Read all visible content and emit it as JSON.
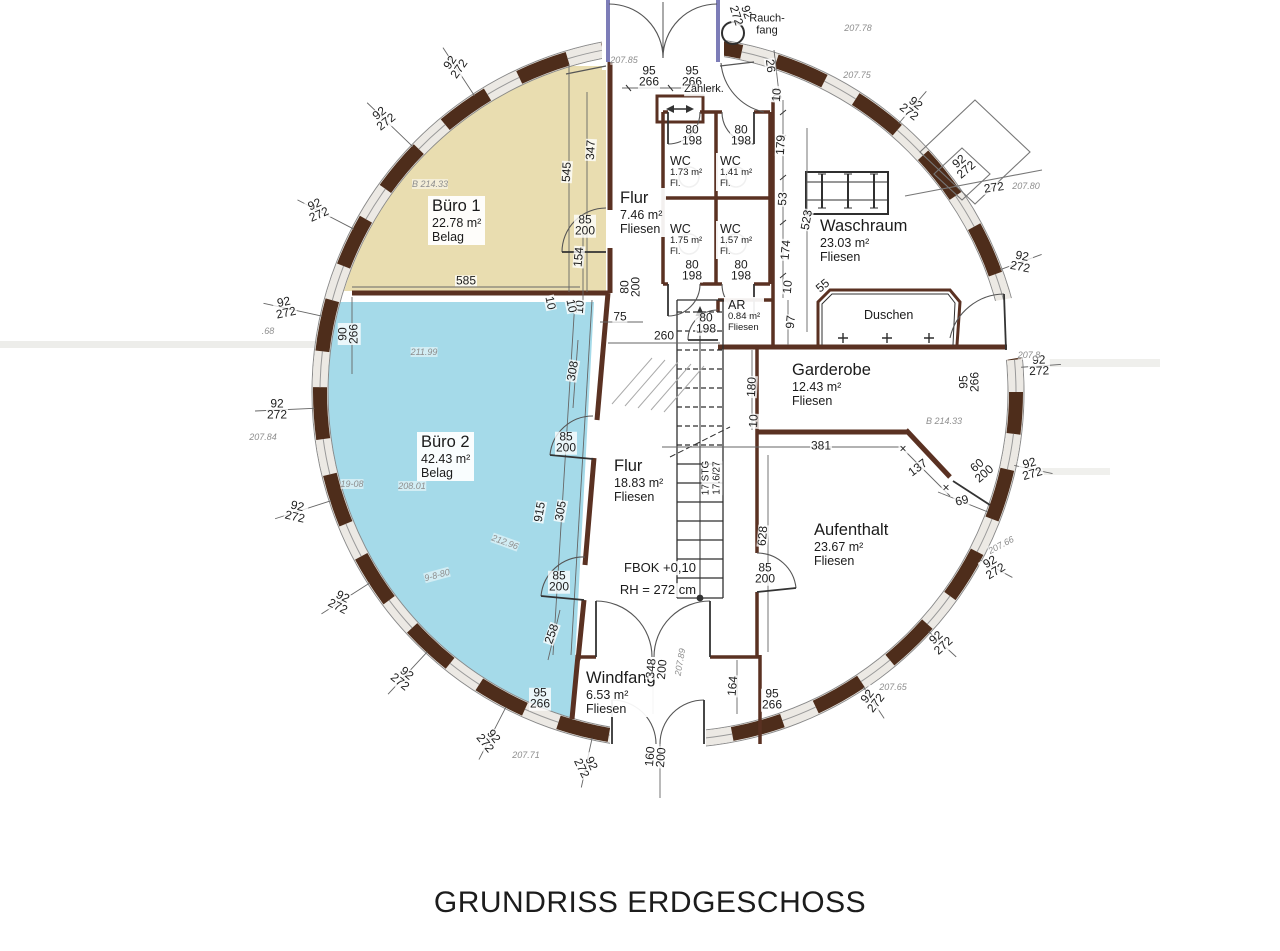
{
  "title": "GRUNDRISS ERDGESCHOSS",
  "colors": {
    "buero1_fill": "#e9ddb0",
    "buero2_fill": "#a5dae9",
    "wall": "#5a3122",
    "ring_dark": "#4e2d1b"
  },
  "rooms": [
    {
      "id": "buero1",
      "name": "Büro 1",
      "area": "22.78 m²",
      "floor": "Belag",
      "x": 428,
      "y": 196,
      "size": "l"
    },
    {
      "id": "buero2",
      "name": "Büro 2",
      "area": "42.43 m²",
      "floor": "Belag",
      "x": 417,
      "y": 432,
      "size": "l"
    },
    {
      "id": "flur-og",
      "name": "Flur",
      "area": "7.46 m²",
      "floor": "Fliesen",
      "x": 616,
      "y": 188,
      "size": "l"
    },
    {
      "id": "waschraum",
      "name": "Waschraum",
      "area": "23.03 m²",
      "floor": "Fliesen",
      "x": 816,
      "y": 216,
      "size": "l"
    },
    {
      "id": "garderobe",
      "name": "Garderobe",
      "area": "12.43 m²",
      "floor": "Fliesen",
      "x": 788,
      "y": 360,
      "size": "l"
    },
    {
      "id": "flur",
      "name": "Flur",
      "area": "18.83 m²",
      "floor": "Fliesen",
      "x": 610,
      "y": 456,
      "size": "l"
    },
    {
      "id": "aufenthalt",
      "name": "Aufenthalt",
      "area": "23.67 m²",
      "floor": "Fliesen",
      "x": 810,
      "y": 520,
      "size": "l"
    },
    {
      "id": "windfang",
      "name": "Windfang",
      "area": "6.53 m²",
      "floor": "Fliesen",
      "x": 582,
      "y": 668,
      "size": "l"
    },
    {
      "id": "ar",
      "name": "AR",
      "area": "0.84 m²",
      "floor": "Fliesen",
      "x": 724,
      "y": 297,
      "size": "s"
    },
    {
      "id": "wc1",
      "name": "WC",
      "area": "1.73 m²",
      "floor": "Fl.",
      "x": 666,
      "y": 153,
      "size": "s"
    },
    {
      "id": "wc2",
      "name": "WC",
      "area": "1.41 m²",
      "floor": "Fl.",
      "x": 716,
      "y": 153,
      "size": "s"
    },
    {
      "id": "wc3",
      "name": "WC",
      "area": "1.75 m²",
      "floor": "Fl.",
      "x": 666,
      "y": 221,
      "size": "s"
    },
    {
      "id": "wc4",
      "name": "WC",
      "area": "1.57 m²",
      "floor": "Fl.",
      "x": 716,
      "y": 221,
      "size": "s"
    },
    {
      "id": "duschen",
      "name": "Duschen",
      "x": 860,
      "y": 307,
      "size": "m"
    }
  ],
  "annotations": [
    {
      "t": "FBOK +0,10",
      "x": 660,
      "y": 568,
      "fs": 13
    },
    {
      "t": "RH = 272 cm",
      "x": 658,
      "y": 590,
      "fs": 13
    },
    {
      "t": "Zählerk.",
      "x": 704,
      "y": 90,
      "fs": 11
    },
    {
      "t": "Rauch-\nfang",
      "x": 767,
      "y": 25,
      "fs": 11
    },
    {
      "t": "17 STG\n17.6/27",
      "x": 712,
      "y": 478,
      "r": -90,
      "fs": 10
    }
  ],
  "dimension_labels": [
    {
      "t": "92\n272",
      "x": 383,
      "y": 118,
      "r": -38,
      "ld": 1
    },
    {
      "t": "92\n272",
      "x": 317,
      "y": 210,
      "r": -24,
      "ld": 1
    },
    {
      "t": "92\n272",
      "x": 285,
      "y": 308,
      "r": -12,
      "ld": 1
    },
    {
      "t": "92\n272",
      "x": 277,
      "y": 410,
      "r": 0,
      "ld": 1
    },
    {
      "t": "92\n272",
      "x": 296,
      "y": 512,
      "r": 13,
      "ld": 1
    },
    {
      "t": "92\n272",
      "x": 340,
      "y": 602,
      "r": 27,
      "ld": 1
    },
    {
      "t": "92\n272",
      "x": 403,
      "y": 678,
      "r": 39,
      "ld": 1
    },
    {
      "t": "92\n272",
      "x": 489,
      "y": 740,
      "r": 51,
      "ld": 1
    },
    {
      "t": "92\n272",
      "x": 586,
      "y": 766,
      "r": 64,
      "ld": 1
    },
    {
      "t": "92\n272",
      "x": 872,
      "y": 700,
      "r": -52,
      "ld": 1
    },
    {
      "t": "92\n272",
      "x": 940,
      "y": 642,
      "r": -42,
      "ld": 1
    },
    {
      "t": "92\n272",
      "x": 993,
      "y": 567,
      "r": -31,
      "ld": 1
    },
    {
      "t": "92\n272",
      "x": 1031,
      "y": 469,
      "r": -16,
      "ld": 1
    },
    {
      "t": "92\n272",
      "x": 1039,
      "y": 366,
      "r": -2,
      "ld": 1
    },
    {
      "t": "92\n272",
      "x": 1021,
      "y": 262,
      "r": 11,
      "ld": 1
    },
    {
      "t": "92\n272",
      "x": 912,
      "y": 108,
      "r": 38,
      "ld": 1
    },
    {
      "t": "92\n272",
      "x": 741,
      "y": 14,
      "r": 72
    },
    {
      "t": "92\n272",
      "x": 455,
      "y": 66,
      "r": -55,
      "ld": 1
    },
    {
      "t": "92\n272",
      "x": 963,
      "y": 166,
      "r": -40
    },
    {
      "t": "272",
      "x": 994,
      "y": 188,
      "r": -8
    },
    {
      "t": "95\n266",
      "x": 649,
      "y": 77
    },
    {
      "t": "95\n266",
      "x": 692,
      "y": 77
    },
    {
      "t": "26",
      "x": 770,
      "y": 66,
      "r": 83
    },
    {
      "t": "10",
      "x": 776,
      "y": 94,
      "r": 83
    },
    {
      "t": "585",
      "x": 466,
      "y": 281
    },
    {
      "t": "545",
      "x": 567,
      "y": 172,
      "r": -87
    },
    {
      "t": "347",
      "x": 591,
      "y": 150,
      "r": -87
    },
    {
      "t": "85\n200",
      "x": 585,
      "y": 226
    },
    {
      "t": "154",
      "x": 579,
      "y": 257,
      "r": -85
    },
    {
      "t": "10",
      "x": 580,
      "y": 307,
      "r": -85
    },
    {
      "t": "90\n266",
      "x": 349,
      "y": 334,
      "r": -90
    },
    {
      "t": "75",
      "x": 620,
      "y": 317
    },
    {
      "t": "260",
      "x": 664,
      "y": 336
    },
    {
      "t": "10",
      "x": 550,
      "y": 303,
      "r": 78
    },
    {
      "t": "10",
      "x": 571,
      "y": 306,
      "r": 78
    },
    {
      "t": "80\n200",
      "x": 631,
      "y": 287,
      "r": -90
    },
    {
      "t": "80\n198",
      "x": 692,
      "y": 136
    },
    {
      "t": "80\n198",
      "x": 741,
      "y": 136
    },
    {
      "t": "80\n198",
      "x": 692,
      "y": 271
    },
    {
      "t": "80\n198",
      "x": 741,
      "y": 271
    },
    {
      "t": "80\n198",
      "x": 706,
      "y": 324
    },
    {
      "t": "10",
      "x": 777,
      "y": 95,
      "r": -85
    },
    {
      "t": "179",
      "x": 781,
      "y": 145,
      "r": -87
    },
    {
      "t": "53",
      "x": 783,
      "y": 199,
      "r": -87
    },
    {
      "t": "174",
      "x": 786,
      "y": 250,
      "r": -85
    },
    {
      "t": "10",
      "x": 788,
      "y": 287,
      "r": -85
    },
    {
      "t": "523",
      "x": 807,
      "y": 220,
      "r": -80
    },
    {
      "t": "55",
      "x": 823,
      "y": 286,
      "r": -40
    },
    {
      "t": "97",
      "x": 791,
      "y": 322,
      "r": -85
    },
    {
      "t": "60\n200",
      "x": 981,
      "y": 470,
      "r": -40
    },
    {
      "t": "69",
      "x": 962,
      "y": 501,
      "r": -14
    },
    {
      "t": "137",
      "x": 918,
      "y": 468,
      "r": -37
    },
    {
      "t": "381",
      "x": 821,
      "y": 446
    },
    {
      "t": "180",
      "x": 752,
      "y": 387,
      "r": -87
    },
    {
      "t": "10",
      "x": 754,
      "y": 421,
      "r": -87
    },
    {
      "t": "95\n266",
      "x": 970,
      "y": 382,
      "r": -90
    },
    {
      "t": "628",
      "x": 763,
      "y": 536,
      "r": -85
    },
    {
      "t": "85\n200",
      "x": 765,
      "y": 574
    },
    {
      "t": "308",
      "x": 573,
      "y": 371,
      "r": -80
    },
    {
      "t": "85\n200",
      "x": 566,
      "y": 443
    },
    {
      "t": "915",
      "x": 540,
      "y": 512,
      "r": -80
    },
    {
      "t": "305",
      "x": 561,
      "y": 511,
      "r": -80
    },
    {
      "t": "85\n200",
      "x": 559,
      "y": 582
    },
    {
      "t": "258",
      "x": 552,
      "y": 634,
      "r": -70
    },
    {
      "t": "348\n200",
      "x": 657,
      "y": 669,
      "r": -85
    },
    {
      "t": "164",
      "x": 733,
      "y": 686,
      "r": -85
    },
    {
      "t": "95\n266",
      "x": 772,
      "y": 700
    },
    {
      "t": "95\n266",
      "x": 540,
      "y": 699
    },
    {
      "t": "160\n200",
      "x": 656,
      "y": 757,
      "r": -85
    },
    {
      "t": "×",
      "x": 903,
      "y": 449
    },
    {
      "t": "×",
      "x": 946,
      "y": 488
    }
  ],
  "handwritten_notes": [
    {
      "t": "207.85",
      "x": 624,
      "y": 60
    },
    {
      "t": "207.78",
      "x": 858,
      "y": 28
    },
    {
      "t": "207.75",
      "x": 857,
      "y": 75
    },
    {
      "t": "207.80",
      "x": 1026,
      "y": 186
    },
    {
      "t": "207.8",
      "x": 1029,
      "y": 355
    },
    {
      "t": "207.66",
      "x": 1001,
      "y": 545,
      "r": -28
    },
    {
      "t": "207.65",
      "x": 893,
      "y": 687
    },
    {
      "t": "207.71",
      "x": 526,
      "y": 755
    },
    {
      "t": "207.84",
      "x": 263,
      "y": 437
    },
    {
      "t": ".68",
      "x": 268,
      "y": 331
    },
    {
      "t": "B  214.33",
      "x": 430,
      "y": 184
    },
    {
      "t": "B  214.33",
      "x": 944,
      "y": 421
    },
    {
      "t": "211.99",
      "x": 424,
      "y": 352
    },
    {
      "t": "208.01",
      "x": 412,
      "y": 486
    },
    {
      "t": "212.96",
      "x": 505,
      "y": 542,
      "r": 20
    },
    {
      "t": "207.89",
      "x": 680,
      "y": 662,
      "r": -80
    },
    {
      "t": "19-08",
      "x": 352,
      "y": 484
    },
    {
      "t": "9-8-80",
      "x": 437,
      "y": 575,
      "r": -15
    }
  ]
}
